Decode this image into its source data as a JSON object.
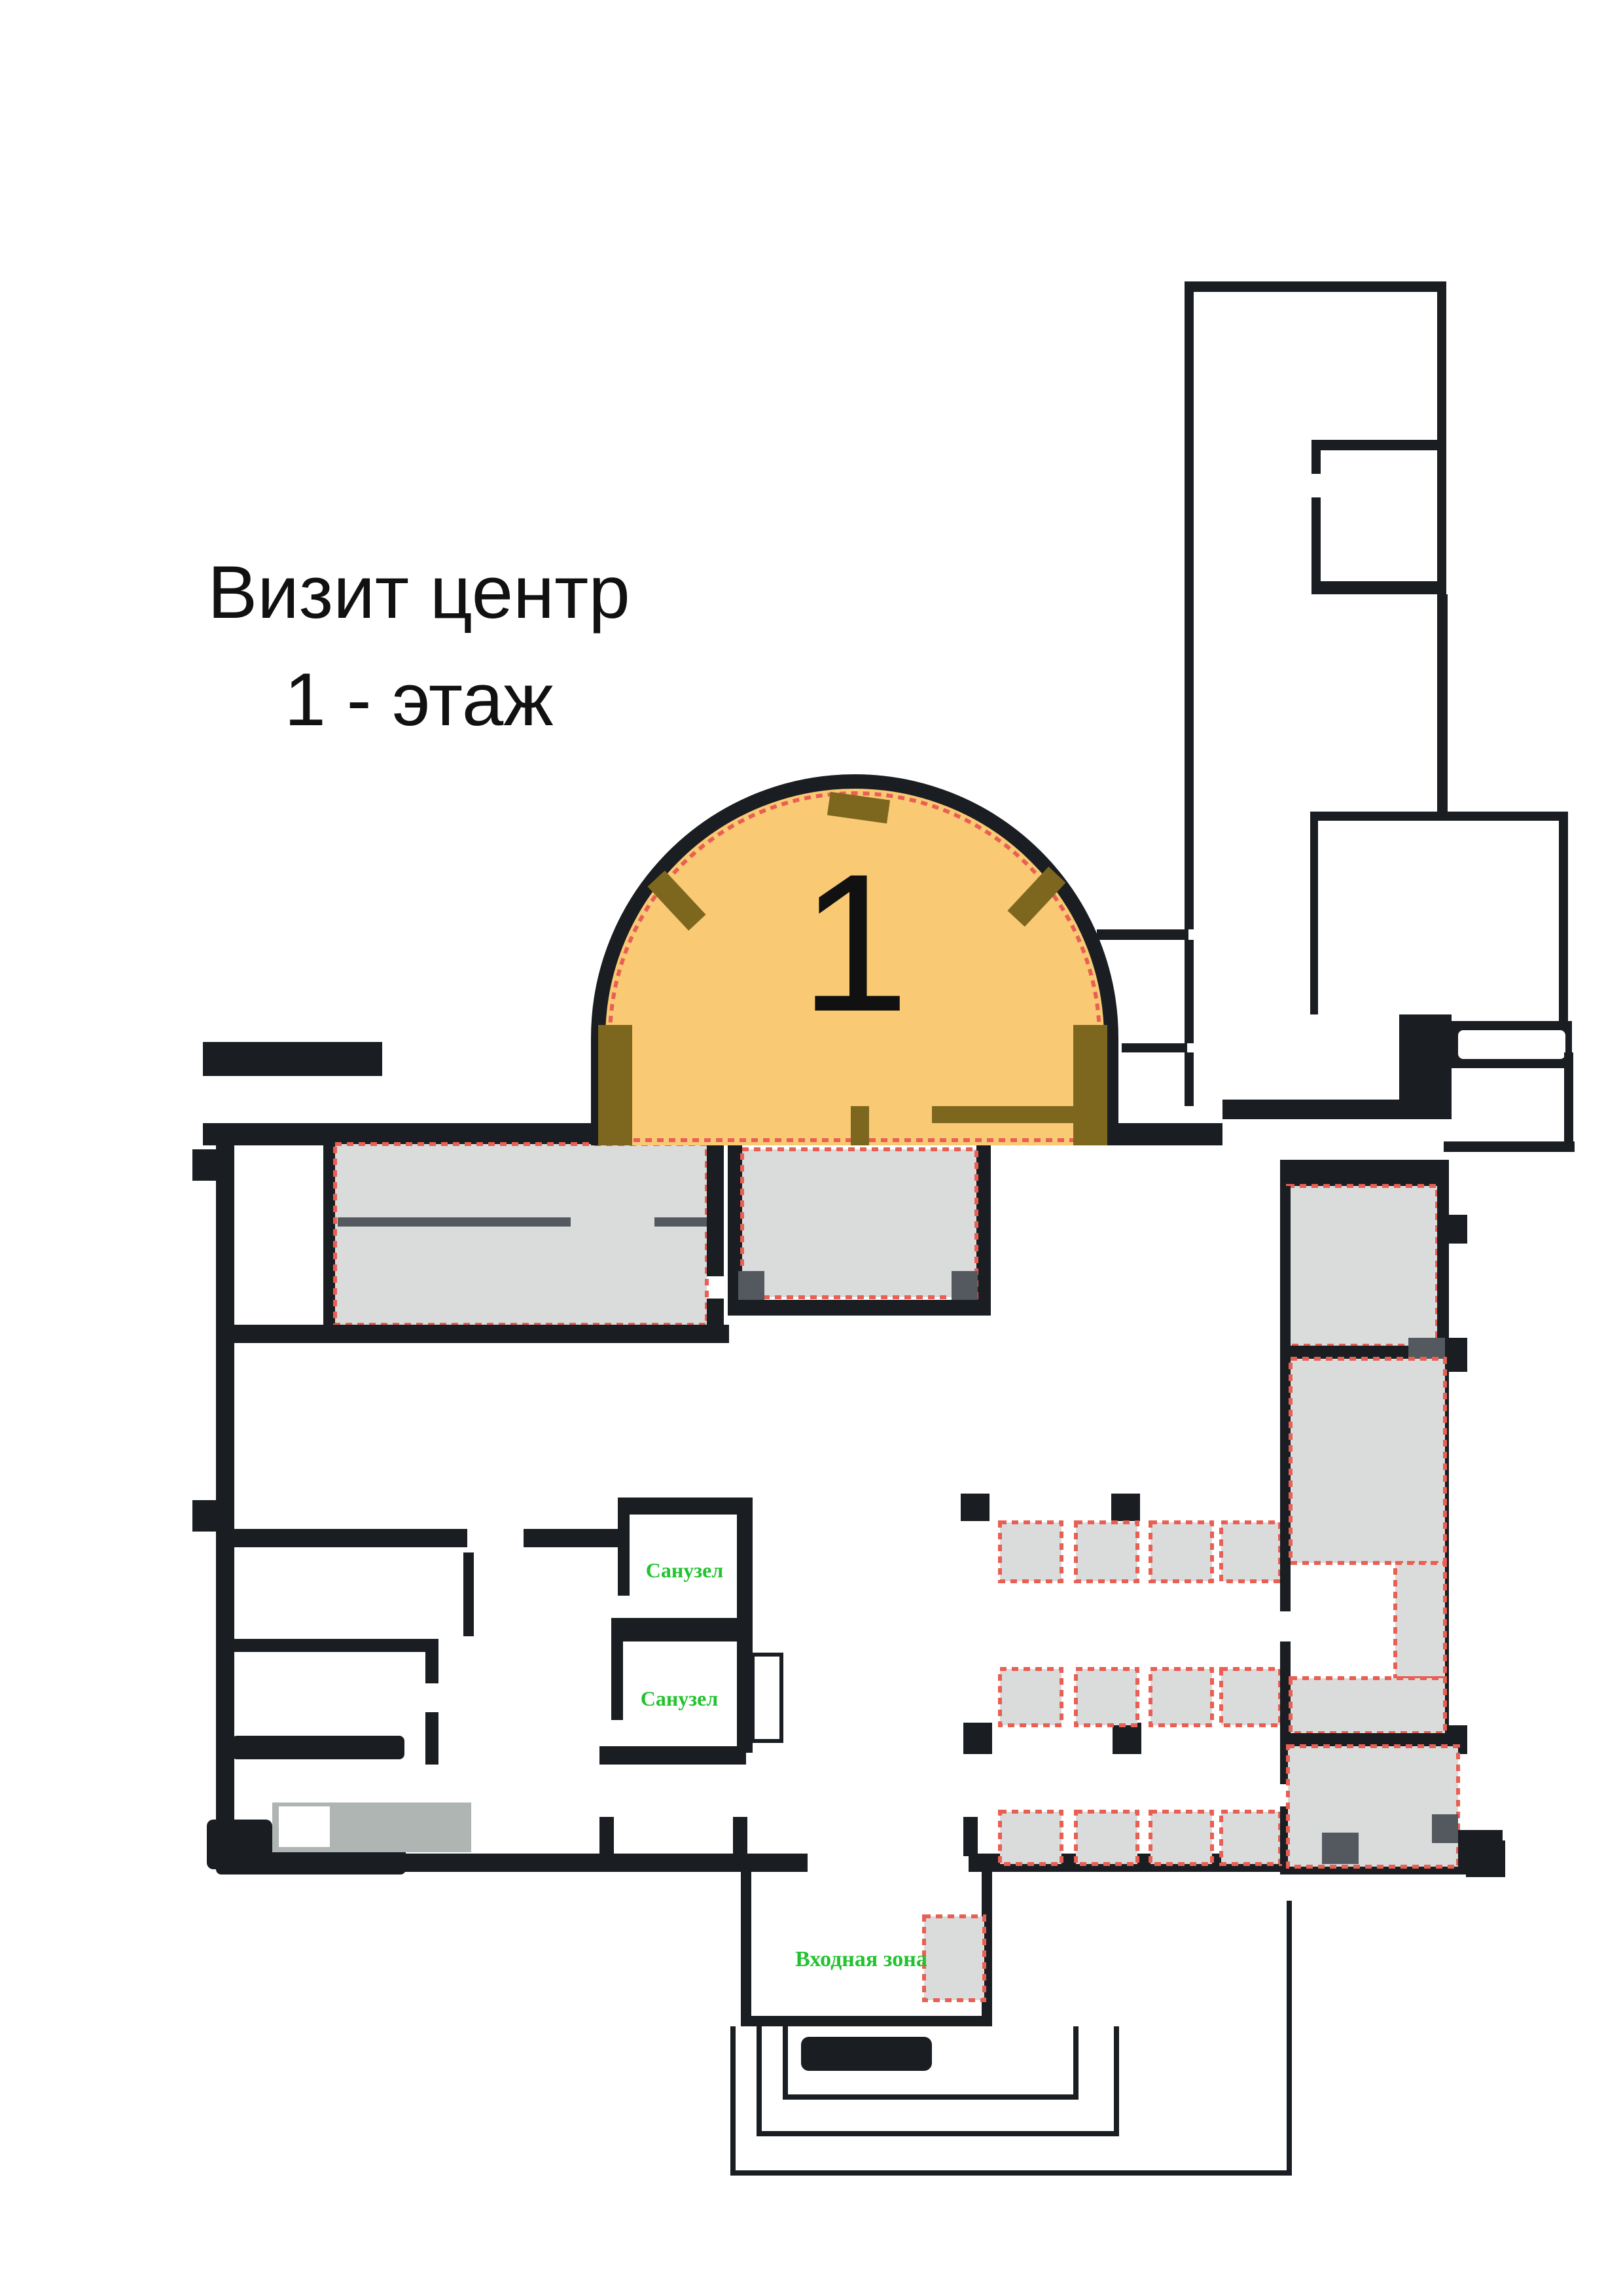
{
  "document": {
    "kind": "floor-plan-drawing"
  },
  "title": {
    "line1": "Визит центр",
    "line2": "1 - этаж"
  },
  "rooms": {
    "dome": {
      "number": "1"
    },
    "bathroom1": {
      "label": "Санузел"
    },
    "bathroom2": {
      "label": "Санузел"
    },
    "entrance": {
      "label": "Входная зона"
    }
  },
  "legend_icons": {
    "furniture_marker": "red-dotted-gray-rectangle",
    "column_marker": "black-square"
  },
  "colors": {
    "wall": "#1a1d21",
    "dome_fill": "#f9c974",
    "dome_wall": "#7d671f",
    "room_fill": "#d9dcdb",
    "accent_dark": "#53595e",
    "desk_fill": "#aeb5b2",
    "dotted": "#e95f54",
    "label_green": "#22c32e",
    "text": "#111111",
    "background": "#ffffff"
  }
}
